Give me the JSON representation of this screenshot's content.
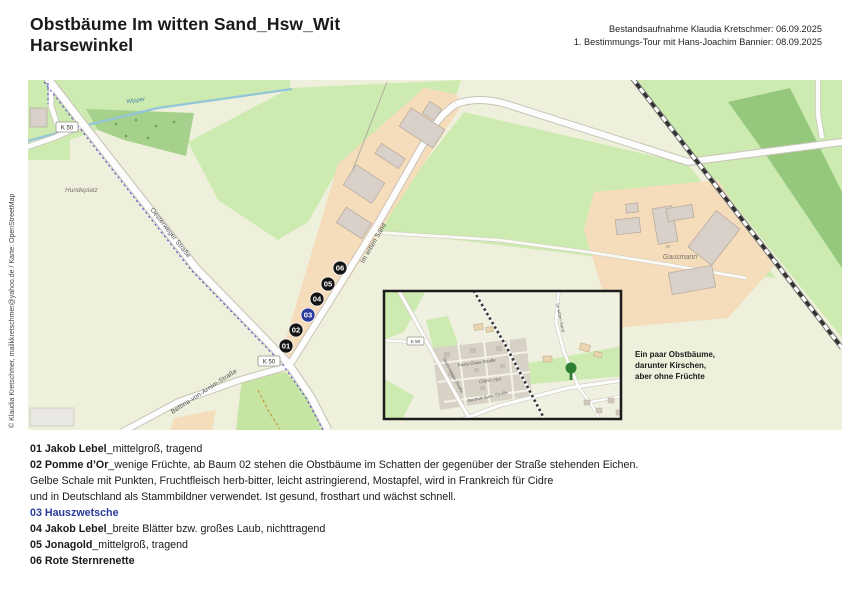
{
  "header": {
    "title_line1": "Obstbäume Im witten Sand_Hsw_Wit",
    "title_line2": "Harsewinkel",
    "meta_line1": "Bestandsaufnahme Klaudia Kretschmer: 06.09.2025",
    "meta_line2": "1. Bestimmungs-Tour mit Hans-Joachim Bannier: 08.09.2025"
  },
  "map": {
    "credit": "© Klaudia Kretschmer, mailkkretschmer@yahoo.de / Karte: OpenStreetMap",
    "labels": {
      "stream": "Wipper",
      "hundeplatz": "Hundeplatz",
      "oesterweger": "Oesterweger Straße",
      "im_witten_sand": "Im witten Sand",
      "bettina": "Bettina-von-Arnim-Straße",
      "gausmann": "Gausmann",
      "house_number": "47",
      "road_ref": "K 50"
    },
    "markers": [
      {
        "id": "01",
        "color": "#141414"
      },
      {
        "id": "02",
        "color": "#141414"
      },
      {
        "id": "03",
        "color": "#2a3b9d"
      },
      {
        "id": "04",
        "color": "#141414"
      },
      {
        "id": "05",
        "color": "#141414"
      },
      {
        "id": "06",
        "color": "#141414"
      }
    ],
    "inset": {
      "labels": {
        "road_ref": "K 50",
        "paula_claas": "Paula-Claas-Straße",
        "olden_hof": "Olden Hof",
        "gertrud_suse": "Gertrud-Suse-Straße",
        "oesterweger": "Oesterweger Straße",
        "im_witten_sand": "Im witten Sand"
      },
      "tree_icon_color": "#2c7f33"
    },
    "note_line1": "Ein paar Obstbäume,",
    "note_line2": "darunter Kirschen,",
    "note_line3": "aber ohne Früchte"
  },
  "legend": {
    "accent_blue": "#2a3b9d",
    "lines": [
      {
        "bold": "01 Jakob Lebel",
        "text": "_mittelgroß, tragend"
      },
      {
        "bold": "02 Pomme d’Or",
        "text": "_wenige Früchte, ab Baum 02 stehen die Obstbäume im Schatten der gegenüber der Straße stehenden Eichen."
      },
      {
        "bold": "",
        "text": "Gelbe Schale mit Punkten, Fruchtfleisch herb-bitter, leicht astringierend, Mostapfel, wird in Frankreich für Cidre"
      },
      {
        "bold": "",
        "text": "und in Deutschland als Stammbildner verwendet. Ist gesund, frosthart und wächst schnell."
      },
      {
        "bold": "03 Hauszwetsche",
        "text": ""
      },
      {
        "bold": "04 Jakob Lebel",
        "text": "_breite Blätter bzw. großes Laub, nichttragend"
      },
      {
        "bold": "05 Jonagold",
        "text": "_mittelgroß, tragend"
      },
      {
        "bold": "06 Rote Sternrenette",
        "text": ""
      }
    ]
  }
}
